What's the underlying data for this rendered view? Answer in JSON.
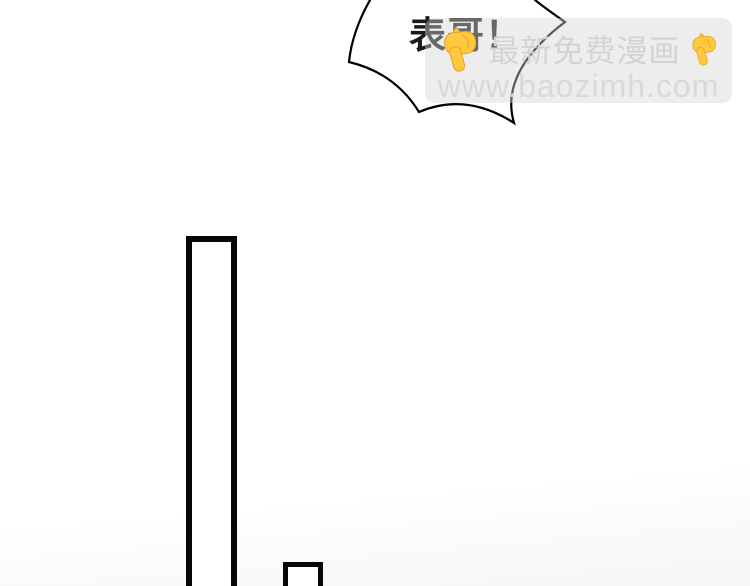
{
  "page": {
    "type": "comic-strip-page",
    "background_color": "#ffffff"
  },
  "speech_bubble": {
    "text": "表哥！",
    "fill_color": "#ffffff",
    "outline_color": "#000000",
    "style": "burst"
  },
  "watermark": {
    "title": "最新免费漫画",
    "url": "www.baozimh.com",
    "box_color_rgba": "rgba(213,213,213,0.42)",
    "title_color": "#d5d2d1",
    "url_color": "#d9d9d9",
    "icons": [
      {
        "name": "pointing-down-icon",
        "glyph": "👇",
        "color": "#FFC83D"
      },
      {
        "name": "pointing-down-icon",
        "glyph": "👇",
        "color": "#FFC83D"
      }
    ]
  },
  "artwork": {
    "panel_frames": [
      {
        "name": "tall-frame",
        "stroke_color": "#070707"
      },
      {
        "name": "small-frame",
        "stroke_color": "#070707"
      }
    ]
  }
}
